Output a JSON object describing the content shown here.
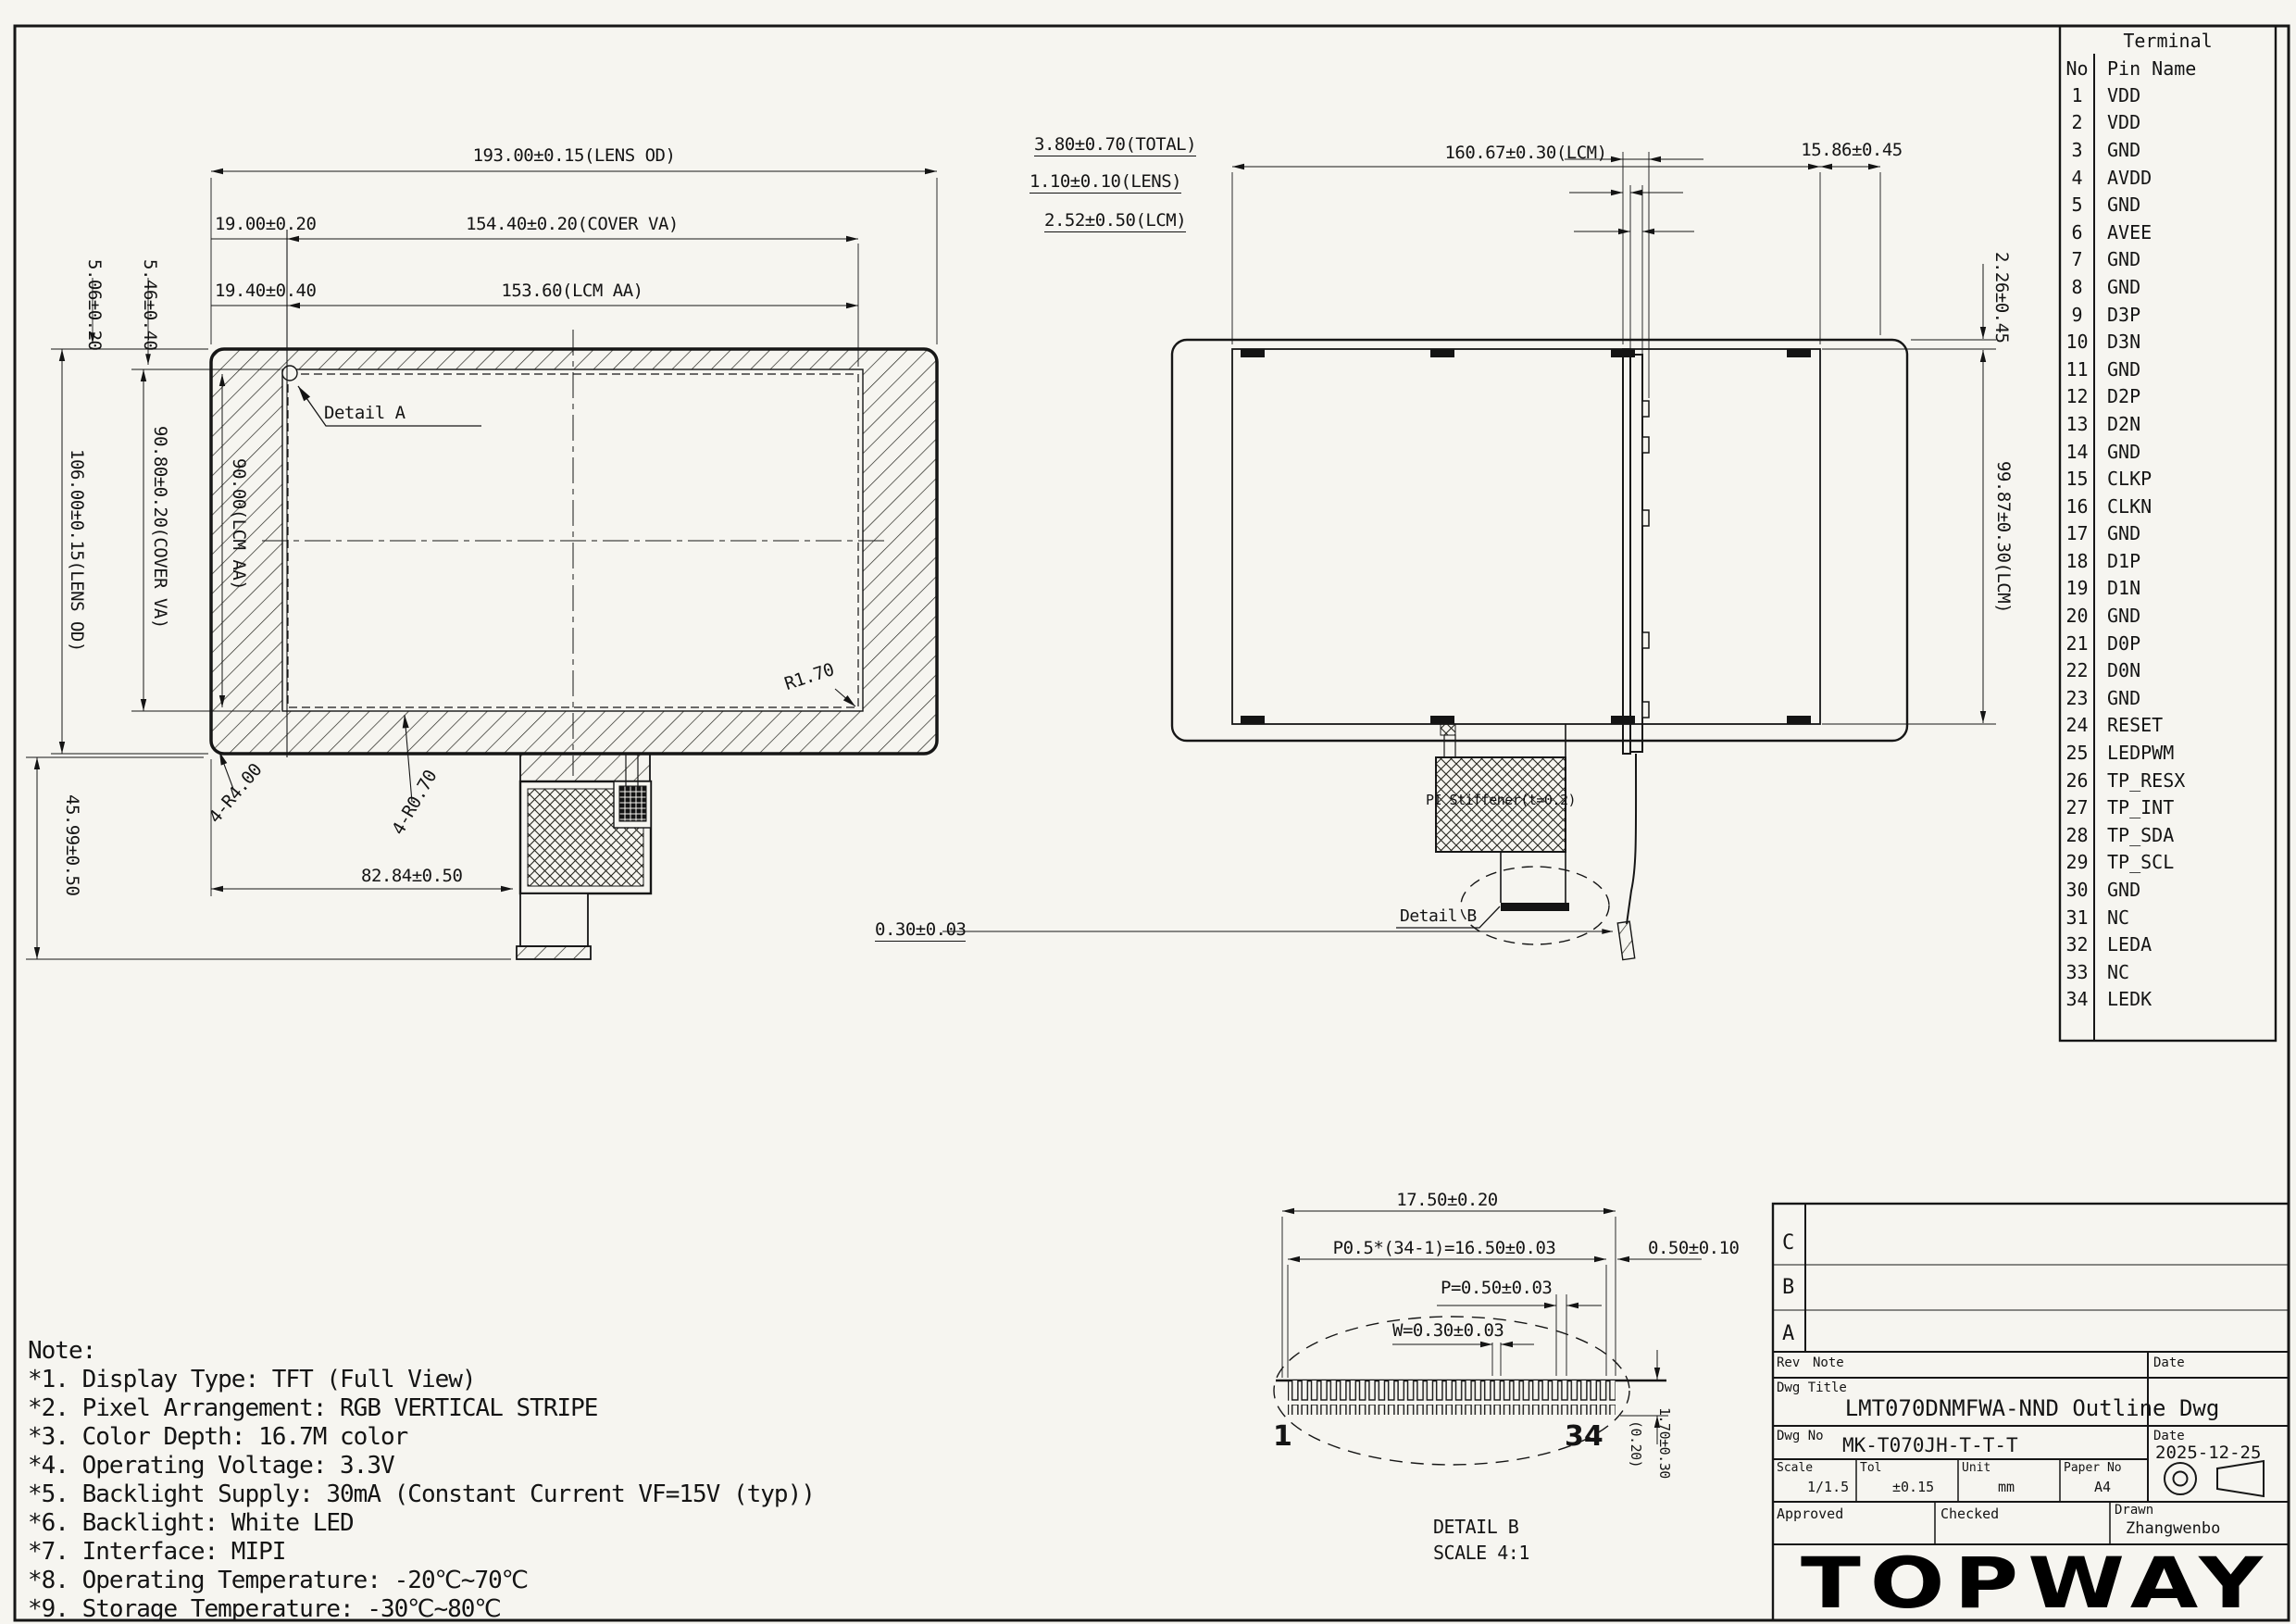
{
  "front_view": {
    "lens_od_w": "193.00±0.15(LENS OD)",
    "cover_va_w": "154.40±0.20(COVER VA)",
    "lcm_aa_w": "153.60(LCM AA)",
    "offset_va": "19.00±0.20",
    "offset_aa": "19.40±0.40",
    "margin_va": "5.06±0.20",
    "margin_aa": "5.46±0.40",
    "lens_od_h": "106.00±0.15(LENS OD)",
    "cover_va_h": "90.80±0.20(COVER VA)",
    "lcm_aa_h": "90.00(LCM AA)",
    "tail_len": "45.99±0.50",
    "fpc_w": "82.84±0.50",
    "radius_inner": "R1.70",
    "radius_corner": "4-R4.00",
    "radius_corner2": "4-R0.70",
    "detail_a": "Detail A"
  },
  "side_view": {
    "total": "3.80±0.70(TOTAL)",
    "lens": "1.10±0.10(LENS)",
    "lcm": "2.52±0.50(LCM)",
    "fpc_thickness": "0.30±0.03"
  },
  "back_view": {
    "lcm_w": "160.67±0.30(LCM)",
    "fpc_offset": "15.86±0.45",
    "top_gap": "2.26±0.45",
    "lcm_h": "99.87±0.30(LCM)",
    "stiffener": "PI Stiffener(t=0.2)",
    "detail_b": "Detail B"
  },
  "detail_b": {
    "total_w": "17.50±0.20",
    "pitch_total": "P0.5*(34-1)=16.50±0.03",
    "end_margin": "0.50±0.10",
    "pitch": "P=0.50±0.03",
    "pin_w": "W=0.30±0.03",
    "first_pin": "1",
    "last_pin": "34",
    "depth": "(0.20)",
    "pin_len": "1.70±0.30",
    "title": "DETAIL B",
    "scale": "SCALE  4:1"
  },
  "pin_table": {
    "title": "Terminal",
    "col_no": "No",
    "col_name": "Pin Name",
    "pins": [
      {
        "no": "1",
        "name": "VDD"
      },
      {
        "no": "2",
        "name": "VDD"
      },
      {
        "no": "3",
        "name": "GND"
      },
      {
        "no": "4",
        "name": "AVDD"
      },
      {
        "no": "5",
        "name": "GND"
      },
      {
        "no": "6",
        "name": "AVEE"
      },
      {
        "no": "7",
        "name": "GND"
      },
      {
        "no": "8",
        "name": "GND"
      },
      {
        "no": "9",
        "name": "D3P"
      },
      {
        "no": "10",
        "name": "D3N"
      },
      {
        "no": "11",
        "name": "GND"
      },
      {
        "no": "12",
        "name": "D2P"
      },
      {
        "no": "13",
        "name": "D2N"
      },
      {
        "no": "14",
        "name": "GND"
      },
      {
        "no": "15",
        "name": "CLKP"
      },
      {
        "no": "16",
        "name": "CLKN"
      },
      {
        "no": "17",
        "name": "GND"
      },
      {
        "no": "18",
        "name": "D1P"
      },
      {
        "no": "19",
        "name": "D1N"
      },
      {
        "no": "20",
        "name": "GND"
      },
      {
        "no": "21",
        "name": "D0P"
      },
      {
        "no": "22",
        "name": "D0N"
      },
      {
        "no": "23",
        "name": "GND"
      },
      {
        "no": "24",
        "name": "RESET"
      },
      {
        "no": "25",
        "name": "LEDPWM"
      },
      {
        "no": "26",
        "name": "TP_RESX"
      },
      {
        "no": "27",
        "name": "TP_INT"
      },
      {
        "no": "28",
        "name": "TP_SDA"
      },
      {
        "no": "29",
        "name": "TP_SCL"
      },
      {
        "no": "30",
        "name": "GND"
      },
      {
        "no": "31",
        "name": "NC"
      },
      {
        "no": "32",
        "name": "LEDA"
      },
      {
        "no": "33",
        "name": "NC"
      },
      {
        "no": "34",
        "name": "LEDK"
      }
    ]
  },
  "notes": {
    "title": "Note:",
    "items": [
      "*1. Display Type: TFT (Full View)",
      "*2. Pixel Arrangement: RGB VERTICAL STRIPE",
      "*3. Color Depth: 16.7M color",
      "*4. Operating Voltage: 3.3V",
      "*5. Backlight Supply: 30mA (Constant Current VF=15V (typ))",
      "*6. Backlight: White LED",
      "*7. Interface: MIPI",
      "*8. Operating Temperature: -20℃~70℃",
      "*9. Storage Temperature: -30℃~80℃"
    ]
  },
  "title_block": {
    "rev_c": "C",
    "rev_b": "B",
    "rev_a": "A",
    "rev_label": "Rev",
    "note_label": "Note",
    "date_header": "Date",
    "dwg_title_label": "Dwg Title",
    "dwg_title": "LMT070DNMFWA-NND Outline Dwg",
    "dwg_no_label": "Dwg No",
    "dwg_no": "MK-T070JH-T-T-T",
    "date_label": "Date",
    "date": "2025-12-25",
    "scale_label": "Scale",
    "scale": "1/1.5",
    "tol_label": "Tol",
    "tol": "±0.15",
    "unit_label": "Unit",
    "unit": "mm",
    "paper_label": "Paper No",
    "paper": "A4",
    "approved_label": "Approved",
    "checked_label": "Checked",
    "drawn_label": "Drawn",
    "drawn": "Zhangwenbo",
    "logo": "TOPWAY"
  }
}
